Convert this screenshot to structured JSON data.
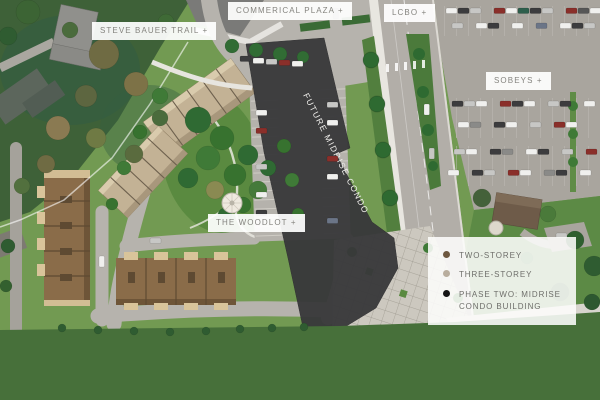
{
  "page": {
    "type": "aerial-site-plan",
    "width": 600,
    "height": 400
  },
  "labels": {
    "steve_bauer_trail": "STEVE BAUER TRAIL +",
    "commerical_plaza": "COMMERICAL PLAZA +",
    "lcbo": "LCBO +",
    "sobeys": "SOBEYS +",
    "the_woodlot": "THE WOODLOT +"
  },
  "buildings": {
    "future_condo_label": "FUTURE MIDRISE CONDO"
  },
  "legend": {
    "items": [
      {
        "label": "TWO-STOREY",
        "color": "#6d573f",
        "dot_style": "background-color:#6d573f"
      },
      {
        "label": "THREE-STOREY",
        "color": "#b9ae9e",
        "dot_style": "background-color:#b9ae9e"
      },
      {
        "label": "PHASE TWO: MIDRISE CONDO BUILDING",
        "color": "#141414",
        "dot_style": "background-color:#141414"
      }
    ]
  },
  "colors": {
    "site_green": "#729a52",
    "greenbelt_band": "#47703a",
    "future_condo_dark": "#38383a",
    "two_storey_brown": "#8a6c49",
    "three_storey_tan": "#c3b295",
    "road_grey": "#b6b3ad",
    "parking_grey": "#a9a59e",
    "label_text_grey": "#85847f"
  }
}
